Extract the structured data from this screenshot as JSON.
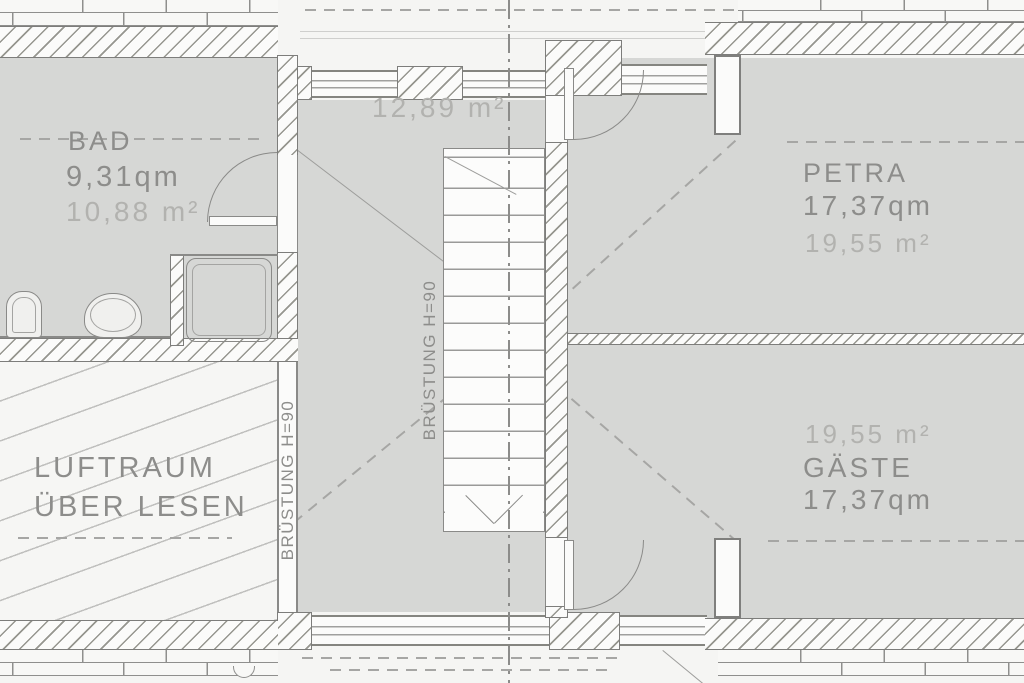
{
  "rooms": {
    "bad": {
      "name": "BAD",
      "area_qm": "9,31qm",
      "area_m2": "10,88 m²"
    },
    "flur": {
      "area_m2": "12,89 m²"
    },
    "petra": {
      "name": "PETRA",
      "area_qm": "17,37qm",
      "area_m2": "19,55 m²"
    },
    "gaeste": {
      "name": "GÄSTE",
      "area_qm": "17,37qm",
      "area_m2": "19,55 m²"
    },
    "luftraum": {
      "name_line1": "LUFTRAUM",
      "name_line2": "ÜBER LESEN"
    }
  },
  "labels": {
    "railing_luftraum": "BRÜSTUNG H=90",
    "railing_stair": "BRÜSTUNG H=90"
  },
  "colors": {
    "room_fill": "#d6d7d5",
    "paper": "#f5f5f3",
    "line": "#8a8a88",
    "text": "#8d8d8b",
    "light_text": "#b2b2af"
  }
}
